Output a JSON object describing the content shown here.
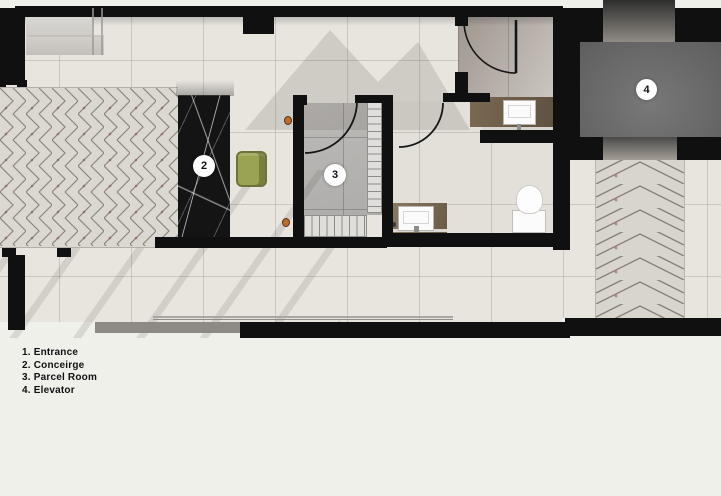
{
  "plan": {
    "type": "lobby-floor-plan",
    "legend": {
      "items": [
        "1. Entrance",
        "2. Conceirge",
        "3. Parcel Room",
        "4. Elevator"
      ]
    },
    "markers": {
      "concierge": {
        "label": "2"
      },
      "parcel_room": {
        "label": "3"
      },
      "elevator": {
        "label": "4"
      }
    },
    "colors": {
      "wall": "#101010",
      "floor_tile": "#e8e5df",
      "parcel_floor": "#b5b3b0",
      "powder_floor": "#a9a29c",
      "elevator_shaft": "#696969",
      "marble_desk": "#141414",
      "chair_olive": "#9aa351",
      "vanity_brown": "#6e5d4a",
      "walkway_marble": "#dbd8d2",
      "sconce_orange": "#c0662a",
      "background": "#eff0ea"
    }
  }
}
